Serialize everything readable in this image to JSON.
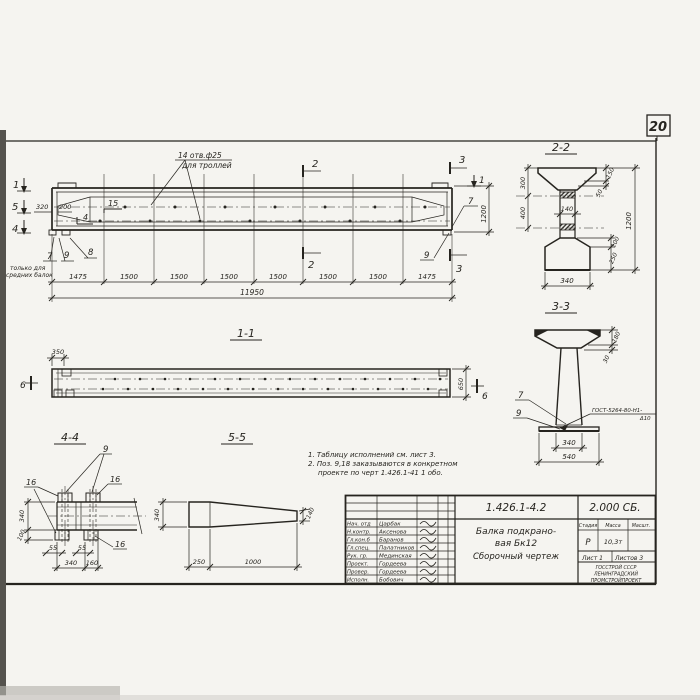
{
  "page": {
    "sheet_corner_number": "20"
  },
  "elevation": {
    "callout": {
      "line1": "14 отв.ф25",
      "line2": "для троллей"
    },
    "marks": {
      "cut1_left": "1",
      "cut5_left": "5",
      "cut4_left": "4",
      "cut2_top": "2",
      "cut2_bottom": "2",
      "cut3_top": "3",
      "cut3_bottom": "3",
      "cut1_right": "1",
      "pos15": "15",
      "cut4_inner": "4"
    },
    "labels": {
      "pos7_left": "7",
      "pos7_note1": "только для",
      "pos7_note2": "средних балок",
      "pos9_left": "9",
      "pos8": "8",
      "pos7_right": "7",
      "pos9_right": "9"
    },
    "dims": {
      "d320": "320",
      "d200": "200",
      "height": "1200",
      "segments": [
        "1475",
        "1500",
        "1500",
        "1500",
        "1500",
        "1500",
        "1500",
        "1475"
      ],
      "total": "11950"
    }
  },
  "section22": {
    "title": "2-2",
    "dims": {
      "left_top": "300",
      "left_bottom": "400",
      "web": "140",
      "right_150": "150",
      "right_50": "50",
      "right_100": "100",
      "right_250": "250",
      "height": "1200",
      "bottom": "340"
    }
  },
  "section33": {
    "title": "3-3",
    "labels": {
      "pos7": "7",
      "pos9": "9"
    },
    "weld": {
      "line1": "ГОСТ-5264-80-Н1-",
      "line2": "Δ10"
    },
    "dims": {
      "d180": "180",
      "d30": "30",
      "d340": "340",
      "d540": "540"
    }
  },
  "view11": {
    "title": "1-1",
    "marks": {
      "left": "6",
      "right": "6"
    },
    "dims": {
      "d350": "350",
      "d650": "650"
    }
  },
  "view44": {
    "title": "4-4",
    "labels": {
      "pos9": "9",
      "pos16_left": "16",
      "pos16_top": "16",
      "pos16_bottom": "16"
    },
    "dims": {
      "d340_left": "340",
      "d100": "100",
      "d55_a": "55",
      "d55_b": "55",
      "d340_bottom": "340",
      "d160": "160"
    }
  },
  "view55": {
    "title": "5-5",
    "dims": {
      "d340": "340",
      "d140": "140",
      "d250": "250",
      "d1000": "1000"
    }
  },
  "notes": {
    "line1": "1. Таблицу исполнений см. лист 3.",
    "line2": "2. Поз. 9,18 заказываются в конкретном",
    "line3": "проекте по черт 1.426.1-41 1 обо."
  },
  "title_block": {
    "doc_number": "1.426.1-4.2",
    "doc_code": "2.000 СБ.",
    "subject_line1": "Балка подкрано-",
    "subject_line2": "вая Бк12",
    "subject_line3": "Сборочный чертеж",
    "headers": {
      "stage": "Стадия",
      "mass": "Масса",
      "scale": "Масшт."
    },
    "values": {
      "stage": "Р",
      "mass": "10,3т"
    },
    "sheet": "Лист 1",
    "sheets": "Листов 3",
    "org": {
      "line1": "ГОССТРОЙ СССР",
      "line2": "ЛЕНИНГРАДСКИЙ",
      "line3": "ПРОМСТРОЙПРОЕКТ"
    },
    "roles": [
      {
        "role": "Нач. отд",
        "name": "Царбак"
      },
      {
        "role": "Н.контр.",
        "name": "Аксенова"
      },
      {
        "role": "Гл.кон.б",
        "name": "Баранов"
      },
      {
        "role": "Гл.спец.",
        "name": "Палатников"
      },
      {
        "role": "Рук. гр.",
        "name": "Мединская"
      },
      {
        "role": "Проект.",
        "name": "Гордеева"
      },
      {
        "role": "Провер.",
        "name": "Гордеева"
      },
      {
        "role": "Исполн.",
        "name": "Бобович"
      }
    ]
  }
}
